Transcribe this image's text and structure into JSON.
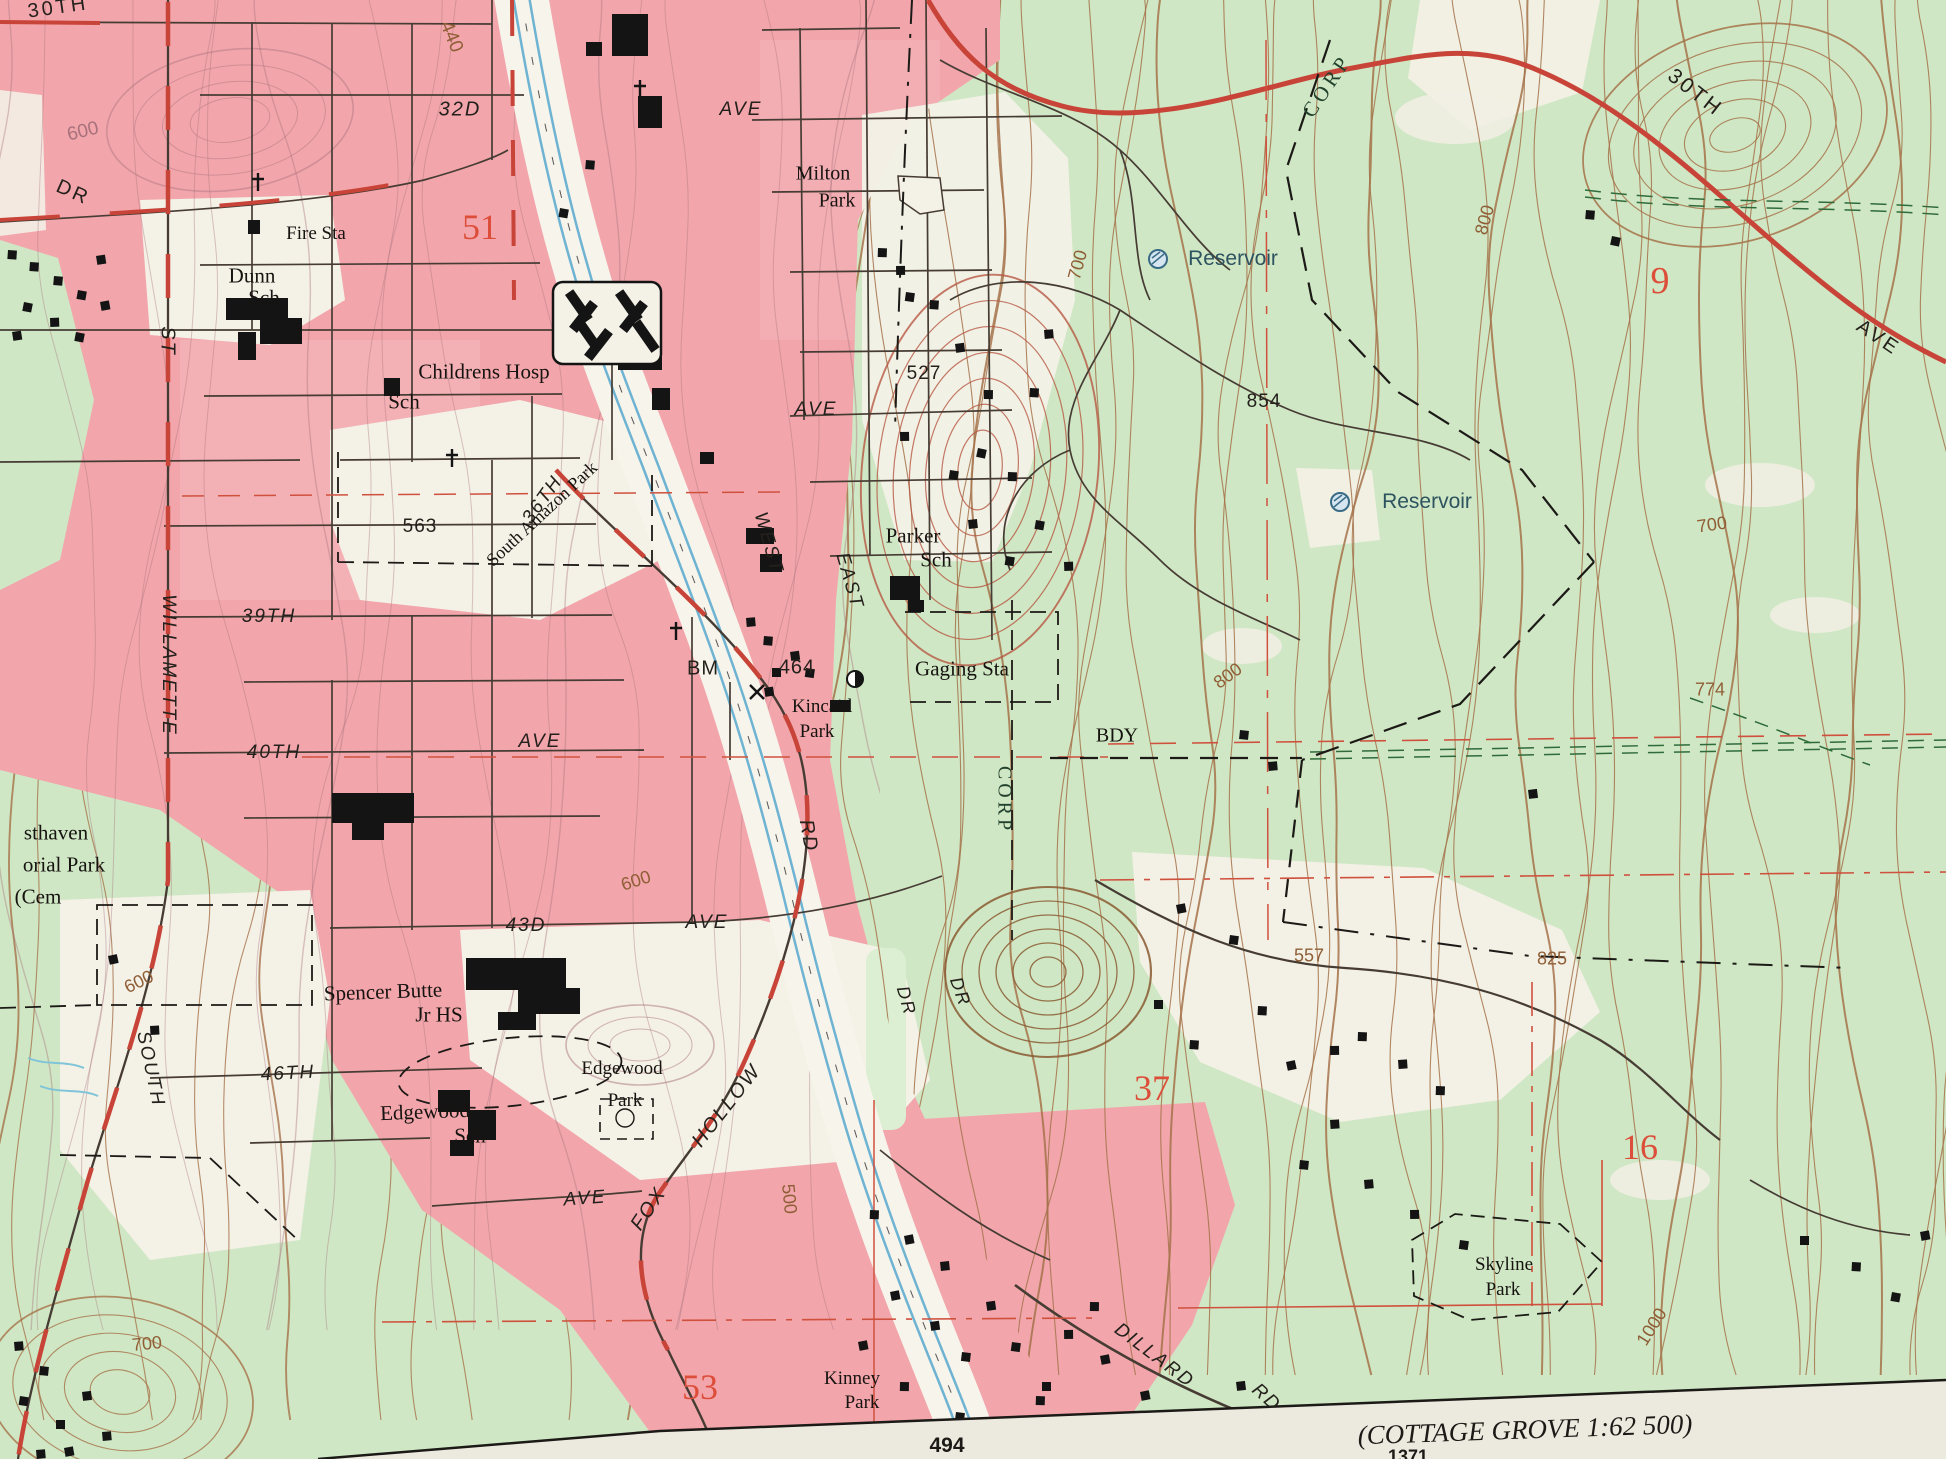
{
  "map": {
    "colors": {
      "urban_pink": "#f2a6ab",
      "woodland_green": "#cfe7c4",
      "open_land_white": "#f4f1e7",
      "contour_brown": "#a5724a",
      "contour_red_brown": "#b65944",
      "road_red": "#c84438",
      "section_number_red": "#dd4e3a",
      "water_blue": "#6fb3d2",
      "margin_paper": "#eceadf"
    },
    "margin": {
      "sheet_note": "(COTTAGE GROVE 1:62 500)",
      "grid_number": "494",
      "partial_number": "1371"
    },
    "symbols": [
      {
        "type": "reservoir",
        "x": 1158,
        "y": 259
      },
      {
        "type": "reservoir",
        "x": 1340,
        "y": 502
      },
      {
        "type": "gaging-station",
        "x": 855,
        "y": 679
      },
      {
        "type": "benchmark-x",
        "x": 757,
        "y": 692
      },
      {
        "type": "church-cross",
        "x": 640,
        "y": 89
      },
      {
        "type": "church-cross",
        "x": 452,
        "y": 458
      },
      {
        "type": "church-cross",
        "x": 676,
        "y": 631
      },
      {
        "type": "church-cross",
        "x": 258,
        "y": 182
      }
    ],
    "labels": [
      {
        "t": "30TH",
        "x": 58,
        "y": 8,
        "r": -8,
        "c": "street",
        "s": 20
      },
      {
        "t": "440",
        "x": 451,
        "y": 37,
        "r": 68,
        "c": "contour",
        "s": 19
      },
      {
        "t": "32D",
        "x": 460,
        "y": 110,
        "r": 0,
        "c": "streeti",
        "s": 20
      },
      {
        "t": "AVE",
        "x": 741,
        "y": 110,
        "r": 0,
        "c": "streeti",
        "s": 19
      },
      {
        "t": "600",
        "x": 83,
        "y": 132,
        "r": -14,
        "c": "contourp",
        "s": 19
      },
      {
        "t": "DR",
        "x": 73,
        "y": 193,
        "r": 24,
        "c": "street",
        "s": 20
      },
      {
        "t": "Fire Sta",
        "x": 316,
        "y": 234,
        "r": 0,
        "c": "feat",
        "s": 19
      },
      {
        "t": "51",
        "x": 480,
        "y": 227,
        "r": 0,
        "c": "red",
        "s": 36
      },
      {
        "t": "Milton",
        "x": 823,
        "y": 174,
        "r": 0,
        "c": "feat",
        "s": 20
      },
      {
        "t": "Park",
        "x": 837,
        "y": 201,
        "r": 0,
        "c": "feat",
        "s": 20
      },
      {
        "t": "CORP",
        "x": 1327,
        "y": 86,
        "r": -56,
        "c": "corp",
        "s": 21
      },
      {
        "t": "30TH",
        "x": 1695,
        "y": 93,
        "r": 38,
        "c": "street",
        "s": 21
      },
      {
        "t": "Reservoir",
        "x": 1233,
        "y": 259,
        "r": 0,
        "c": "water",
        "s": 21
      },
      {
        "t": "9",
        "x": 1660,
        "y": 281,
        "r": 0,
        "c": "red",
        "s": 38
      },
      {
        "t": "700",
        "x": 1078,
        "y": 265,
        "r": -75,
        "c": "contour",
        "s": 18
      },
      {
        "t": "800",
        "x": 1485,
        "y": 220,
        "r": -75,
        "c": "contour",
        "s": 18
      },
      {
        "t": "AVE",
        "x": 1878,
        "y": 338,
        "r": 34,
        "c": "street",
        "s": 20
      },
      {
        "t": "Dunn",
        "x": 252,
        "y": 276,
        "r": 0,
        "c": "feat",
        "s": 21
      },
      {
        "t": "Sch",
        "x": 264,
        "y": 298,
        "r": 0,
        "c": "feat",
        "s": 21
      },
      {
        "t": "ST",
        "x": 167,
        "y": 341,
        "r": 90,
        "c": "streeti",
        "s": 20
      },
      {
        "t": "Childrens Hosp",
        "x": 484,
        "y": 372,
        "r": 0,
        "c": "feat",
        "s": 21
      },
      {
        "t": "Sch",
        "x": 404,
        "y": 402,
        "r": 0,
        "c": "feat",
        "s": 21
      },
      {
        "t": "527",
        "x": 924,
        "y": 374,
        "r": 0,
        "c": "spot",
        "s": 19
      },
      {
        "t": "854",
        "x": 1264,
        "y": 402,
        "r": 0,
        "c": "spot",
        "s": 19
      },
      {
        "t": "Reservoir",
        "x": 1427,
        "y": 502,
        "r": 0,
        "c": "water",
        "s": 21
      },
      {
        "t": "700",
        "x": 1712,
        "y": 525,
        "r": -8,
        "c": "contour",
        "s": 18
      },
      {
        "t": "563",
        "x": 420,
        "y": 527,
        "r": 0,
        "c": "spot",
        "s": 19
      },
      {
        "t": "36TH",
        "x": 543,
        "y": 500,
        "r": -54,
        "c": "streeti",
        "s": 19
      },
      {
        "t": "South Amazon Park",
        "x": 542,
        "y": 514,
        "r": -43,
        "c": "feat",
        "s": 18
      },
      {
        "t": "AVE",
        "x": 816,
        "y": 410,
        "r": 0,
        "c": "streeti",
        "s": 19
      },
      {
        "t": "Parker",
        "x": 913,
        "y": 536,
        "r": 0,
        "c": "feat",
        "s": 21
      },
      {
        "t": "Sch",
        "x": 936,
        "y": 560,
        "r": 0,
        "c": "feat",
        "s": 21
      },
      {
        "t": "WEST",
        "x": 768,
        "y": 543,
        "r": 74,
        "c": "streeti",
        "s": 19
      },
      {
        "t": "EAST",
        "x": 849,
        "y": 581,
        "r": 74,
        "c": "streeti",
        "s": 19
      },
      {
        "t": "39TH",
        "x": 269,
        "y": 617,
        "r": 0,
        "c": "streeti",
        "s": 19
      },
      {
        "t": "WILLAMETTE",
        "x": 168,
        "y": 665,
        "r": 90,
        "c": "streeti",
        "s": 19
      },
      {
        "t": "BM",
        "x": 703,
        "y": 669,
        "r": 0,
        "c": "spot",
        "s": 20
      },
      {
        "t": "464",
        "x": 797,
        "y": 668,
        "r": 0,
        "c": "spot",
        "s": 20
      },
      {
        "t": "Gaging Sta",
        "x": 962,
        "y": 669,
        "r": 0,
        "c": "feat",
        "s": 21
      },
      {
        "t": "Kincaid",
        "x": 822,
        "y": 707,
        "r": 0,
        "c": "feat",
        "s": 19
      },
      {
        "t": "Park",
        "x": 817,
        "y": 732,
        "r": 0,
        "c": "feat",
        "s": 19
      },
      {
        "t": "800",
        "x": 1228,
        "y": 676,
        "r": -36,
        "c": "contour",
        "s": 18
      },
      {
        "t": "BDY",
        "x": 1117,
        "y": 736,
        "r": 0,
        "c": "feat",
        "s": 20
      },
      {
        "t": "774",
        "x": 1710,
        "y": 690,
        "r": 0,
        "c": "contour",
        "s": 18
      },
      {
        "t": "40TH",
        "x": 274,
        "y": 753,
        "r": 0,
        "c": "streeti",
        "s": 19
      },
      {
        "t": "AVE",
        "x": 540,
        "y": 742,
        "r": 0,
        "c": "streeti",
        "s": 19
      },
      {
        "t": "RD",
        "x": 808,
        "y": 836,
        "r": 80,
        "c": "streeti",
        "s": 20
      },
      {
        "t": "CORP",
        "x": 1004,
        "y": 800,
        "r": 90,
        "c": "corp",
        "s": 20
      },
      {
        "t": "sthaven",
        "x": 56,
        "y": 833,
        "r": 0,
        "c": "feat",
        "s": 21
      },
      {
        "t": "orial Park",
        "x": 64,
        "y": 865,
        "r": 0,
        "c": "feat",
        "s": 21
      },
      {
        "t": "(Cem",
        "x": 38,
        "y": 897,
        "r": 0,
        "c": "feat",
        "s": 21
      },
      {
        "t": "600",
        "x": 636,
        "y": 881,
        "r": -18,
        "c": "contour",
        "s": 18
      },
      {
        "t": "600",
        "x": 139,
        "y": 982,
        "r": -26,
        "c": "contour",
        "s": 18
      },
      {
        "t": "43D",
        "x": 526,
        "y": 926,
        "r": 0,
        "c": "streeti",
        "s": 19
      },
      {
        "t": "AVE",
        "x": 707,
        "y": 923,
        "r": 0,
        "c": "streeti",
        "s": 19
      },
      {
        "t": "557",
        "x": 1309,
        "y": 956,
        "r": 0,
        "c": "contour",
        "s": 18
      },
      {
        "t": "825",
        "x": 1552,
        "y": 959,
        "r": 0,
        "c": "contour",
        "s": 18
      },
      {
        "t": "Spencer Butte",
        "x": 383,
        "y": 992,
        "r": -2,
        "c": "feat",
        "s": 21
      },
      {
        "t": "Jr HS",
        "x": 439,
        "y": 1015,
        "r": 0,
        "c": "feat",
        "s": 21
      },
      {
        "t": "SOUTH",
        "x": 150,
        "y": 1069,
        "r": 78,
        "c": "streeti",
        "s": 19
      },
      {
        "t": "46TH",
        "x": 288,
        "y": 1074,
        "r": -3,
        "c": "streeti",
        "s": 19
      },
      {
        "t": "Edgewood",
        "x": 622,
        "y": 1069,
        "r": 0,
        "c": "feat",
        "s": 19
      },
      {
        "t": "Park",
        "x": 625,
        "y": 1101,
        "r": 0,
        "c": "feat",
        "s": 19
      },
      {
        "t": "Edgewood",
        "x": 425,
        "y": 1112,
        "r": -2,
        "c": "feat",
        "s": 21
      },
      {
        "t": "Sch",
        "x": 470,
        "y": 1136,
        "r": 0,
        "c": "feat",
        "s": 21
      },
      {
        "t": "37",
        "x": 1152,
        "y": 1088,
        "r": 0,
        "c": "red",
        "s": 36
      },
      {
        "t": "HOLLOW",
        "x": 727,
        "y": 1106,
        "r": -52,
        "c": "streeti",
        "s": 20
      },
      {
        "t": "FOX",
        "x": 649,
        "y": 1209,
        "r": -56,
        "c": "streeti",
        "s": 20
      },
      {
        "t": "16",
        "x": 1640,
        "y": 1147,
        "r": 0,
        "c": "red",
        "s": 36
      },
      {
        "t": "AVE",
        "x": 585,
        "y": 1199,
        "r": -4,
        "c": "streeti",
        "s": 19
      },
      {
        "t": "500",
        "x": 789,
        "y": 1199,
        "r": 84,
        "c": "contour",
        "s": 18
      },
      {
        "t": "DR",
        "x": 906,
        "y": 1001,
        "r": 74,
        "c": "streeti",
        "s": 18
      },
      {
        "t": "DR",
        "x": 960,
        "y": 992,
        "r": 70,
        "c": "streeti",
        "s": 18
      },
      {
        "t": "700",
        "x": 147,
        "y": 1344,
        "r": -6,
        "c": "contour",
        "s": 18
      },
      {
        "t": "53",
        "x": 700,
        "y": 1387,
        "r": 0,
        "c": "red",
        "s": 36
      },
      {
        "t": "Kinney",
        "x": 852,
        "y": 1379,
        "r": 0,
        "c": "feat",
        "s": 19
      },
      {
        "t": "Park",
        "x": 862,
        "y": 1403,
        "r": 0,
        "c": "feat",
        "s": 19
      },
      {
        "t": "Skyline",
        "x": 1504,
        "y": 1265,
        "r": 0,
        "c": "feat",
        "s": 19
      },
      {
        "t": "Park",
        "x": 1503,
        "y": 1290,
        "r": 0,
        "c": "feat",
        "s": 19
      },
      {
        "t": "1000",
        "x": 1652,
        "y": 1327,
        "r": -58,
        "c": "contour",
        "s": 18
      },
      {
        "t": "DILLARD",
        "x": 1154,
        "y": 1356,
        "r": 37,
        "c": "streeti",
        "s": 19
      },
      {
        "t": "RD",
        "x": 1266,
        "y": 1398,
        "r": 42,
        "c": "streeti",
        "s": 19
      }
    ]
  }
}
